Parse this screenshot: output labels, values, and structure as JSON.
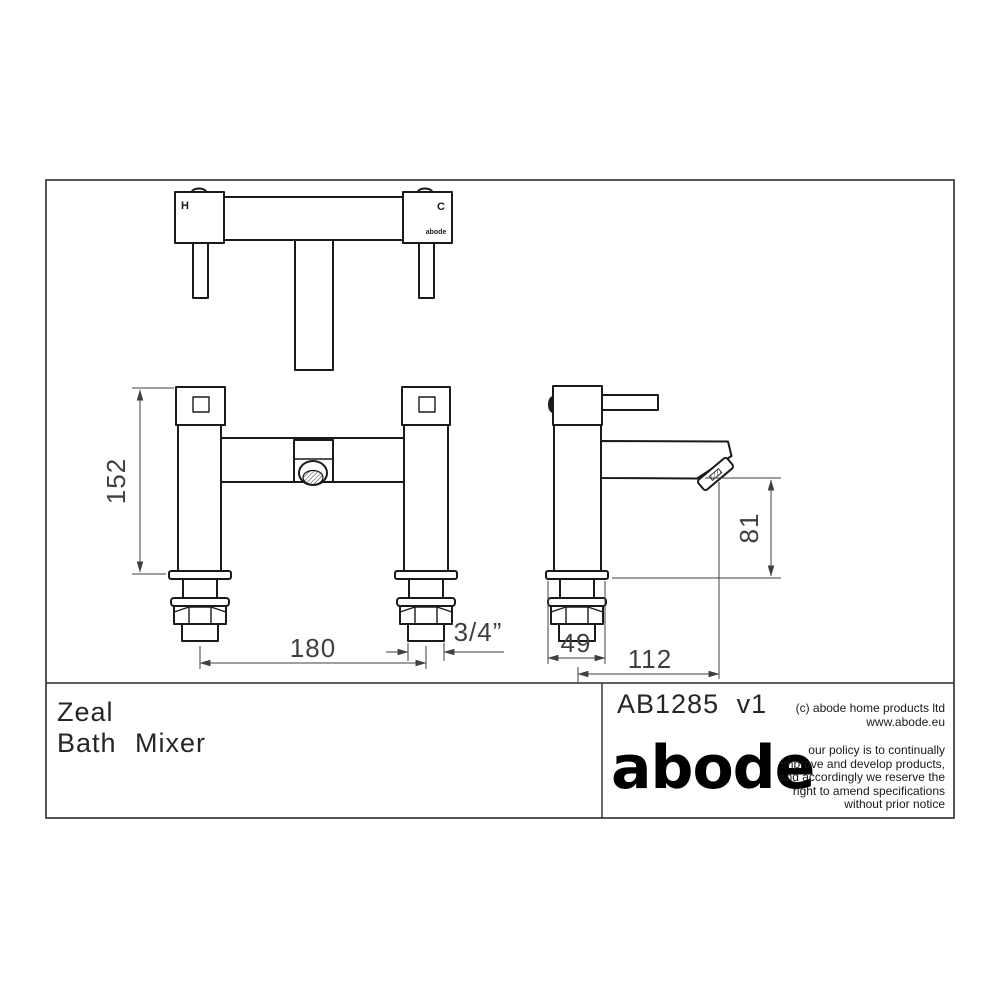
{
  "colors": {
    "line": "#1a1a1a",
    "dimension": "#3f3f3f",
    "text": "#262626",
    "background": "#ffffff"
  },
  "title_block": {
    "product_line1": "Zeal",
    "product_line2": "Bath Mixer",
    "product_code": "AB1285 v1",
    "brand_logo": "abode",
    "copyright_line1": "(c) abode home products ltd",
    "copyright_line2": "www.abode.eu",
    "policy_line1": "our policy is to continually",
    "policy_line2": "improve and develop products,",
    "policy_line3": "and accordingly we reserve the",
    "policy_line4": "right to amend specifications",
    "policy_line5": "without prior notice"
  },
  "top_view": {
    "hot_label": "H",
    "cold_label": "C",
    "brand_mark": "abode"
  },
  "dimensions": {
    "body_height_mm": "152",
    "inlet_centres_mm": "180",
    "thread_size": "3/4”",
    "base_width_mm": "49",
    "spout_reach_mm": "112",
    "spout_height_mm": "81"
  }
}
